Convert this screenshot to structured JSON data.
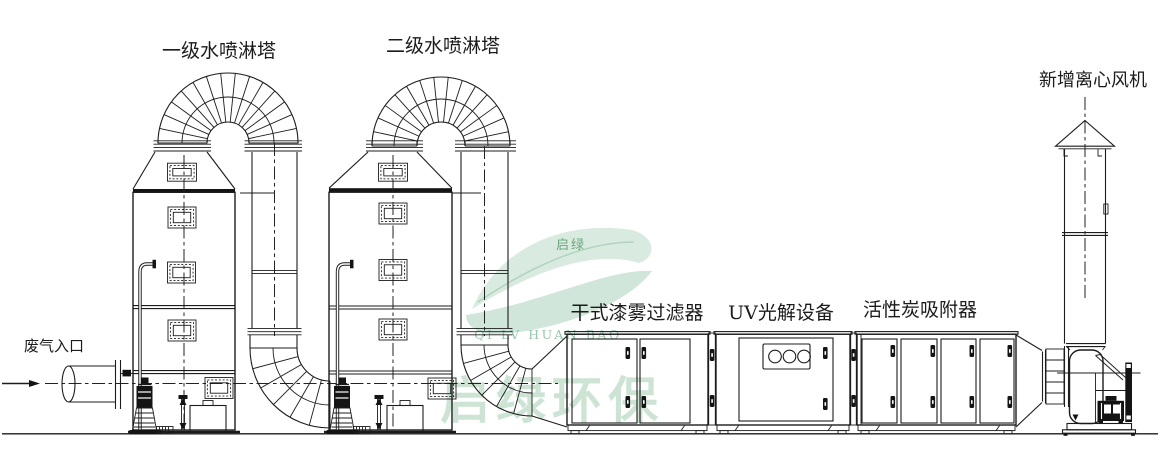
{
  "diagram": {
    "background": "#ffffff",
    "line_color": "#1c1c1c",
    "labels": {
      "waste_gas_inlet": "废气入口",
      "spray_tower_1": "一级水喷淋塔",
      "spray_tower_2": "二级水喷淋塔",
      "dry_paint_mist_filter": "干式漆雾过滤器",
      "uv_photolysis_unit": "UV光解设备",
      "activated_carbon_adsorber": "活性炭吸附器",
      "new_centrifugal_fan": "新增离心风机"
    },
    "watermark": {
      "logo_text": "启绿",
      "latin_text": "QI LV HUAN BAO",
      "brand_text": "启绿环保",
      "color": "#9ccbad"
    }
  }
}
